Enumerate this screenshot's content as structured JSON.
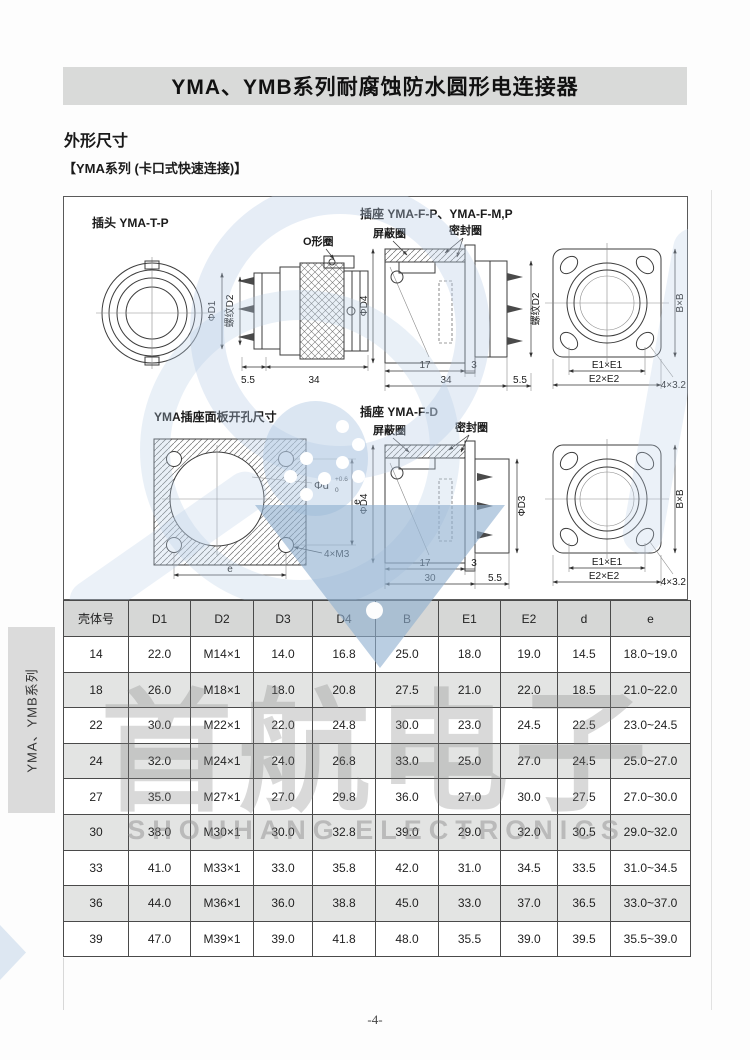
{
  "page": {
    "title": "YMA、YMB系列耐腐蚀防水圆形电连接器",
    "section_heading": "外形尺寸",
    "series_note": "【YMA系列 (卡口式快速连接)】",
    "side_tab": "YMA、YMB系列",
    "page_number": "-4-"
  },
  "watermark": {
    "cn": "首航电子",
    "en": "SHOUHANG ELECTRONICS"
  },
  "drawings": {
    "plug": {
      "title": "插头 YMA-T-P",
      "oring": "O形圈",
      "dim_d1": "ΦD1",
      "dim_thread_d2": "螺纹D2",
      "dim_5_5": "5.5",
      "dim_34": "34"
    },
    "socket_fp": {
      "title": "插座 YMA-F-P、YMA-F-M,P",
      "shield_ring": "屏蔽圈",
      "seal_ring": "密封圈",
      "dim_d4": "ΦD4",
      "dim_thread_d2": "螺纹D2",
      "dim_17": "17",
      "dim_3": "3",
      "dim_34": "34",
      "dim_5_5": "5.5",
      "dim_bxb": "B×B",
      "dim_e1": "E1×E1",
      "dim_e2": "E2×E2",
      "dim_holes": "4×3.2"
    },
    "panel": {
      "title": "YMA插座面板开孔尺寸",
      "dim_phi_d": "Φd",
      "tol_upper": "+0.6",
      "tol_lower": "0",
      "dim_e": "e",
      "dim_m3": "4×M3"
    },
    "socket_fd": {
      "title": "插座 YMA-F-D",
      "shield_ring": "屏蔽圈",
      "seal_ring": "密封圈",
      "dim_d4": "ΦD4",
      "dim_d3": "ΦD3",
      "dim_17": "17",
      "dim_3": "3",
      "dim_30": "30",
      "dim_5_5": "5.5",
      "dim_bxb": "B×B",
      "dim_e1": "E1×E1",
      "dim_e2": "E2×E2",
      "dim_holes": "4×3.2"
    }
  },
  "table": {
    "headers": [
      "壳体号",
      "D1",
      "D2",
      "D3",
      "D4",
      "B",
      "E1",
      "E2",
      "d",
      "e"
    ],
    "rows": [
      [
        "14",
        "22.0",
        "M14×1",
        "14.0",
        "16.8",
        "25.0",
        "18.0",
        "19.0",
        "14.5",
        "18.0~19.0"
      ],
      [
        "18",
        "26.0",
        "M18×1",
        "18.0",
        "20.8",
        "27.5",
        "21.0",
        "22.0",
        "18.5",
        "21.0~22.0"
      ],
      [
        "22",
        "30.0",
        "M22×1",
        "22.0",
        "24.8",
        "30.0",
        "23.0",
        "24.5",
        "22.5",
        "23.0~24.5"
      ],
      [
        "24",
        "32.0",
        "M24×1",
        "24.0",
        "26.8",
        "33.0",
        "25.0",
        "27.0",
        "24.5",
        "25.0~27.0"
      ],
      [
        "27",
        "35.0",
        "M27×1",
        "27.0",
        "29.8",
        "36.0",
        "27.0",
        "30.0",
        "27.5",
        "27.0~30.0"
      ],
      [
        "30",
        "38.0",
        "M30×1",
        "30.0",
        "32.8",
        "39.0",
        "29.0",
        "32.0",
        "30.5",
        "29.0~32.0"
      ],
      [
        "33",
        "41.0",
        "M33×1",
        "33.0",
        "35.8",
        "42.0",
        "31.0",
        "34.5",
        "33.5",
        "31.0~34.5"
      ],
      [
        "36",
        "44.0",
        "M36×1",
        "36.0",
        "38.8",
        "45.0",
        "33.0",
        "37.0",
        "36.5",
        "33.0~37.0"
      ],
      [
        "39",
        "47.0",
        "M39×1",
        "39.0",
        "41.8",
        "48.0",
        "35.5",
        "39.0",
        "39.5",
        "35.5~39.0"
      ]
    ]
  }
}
